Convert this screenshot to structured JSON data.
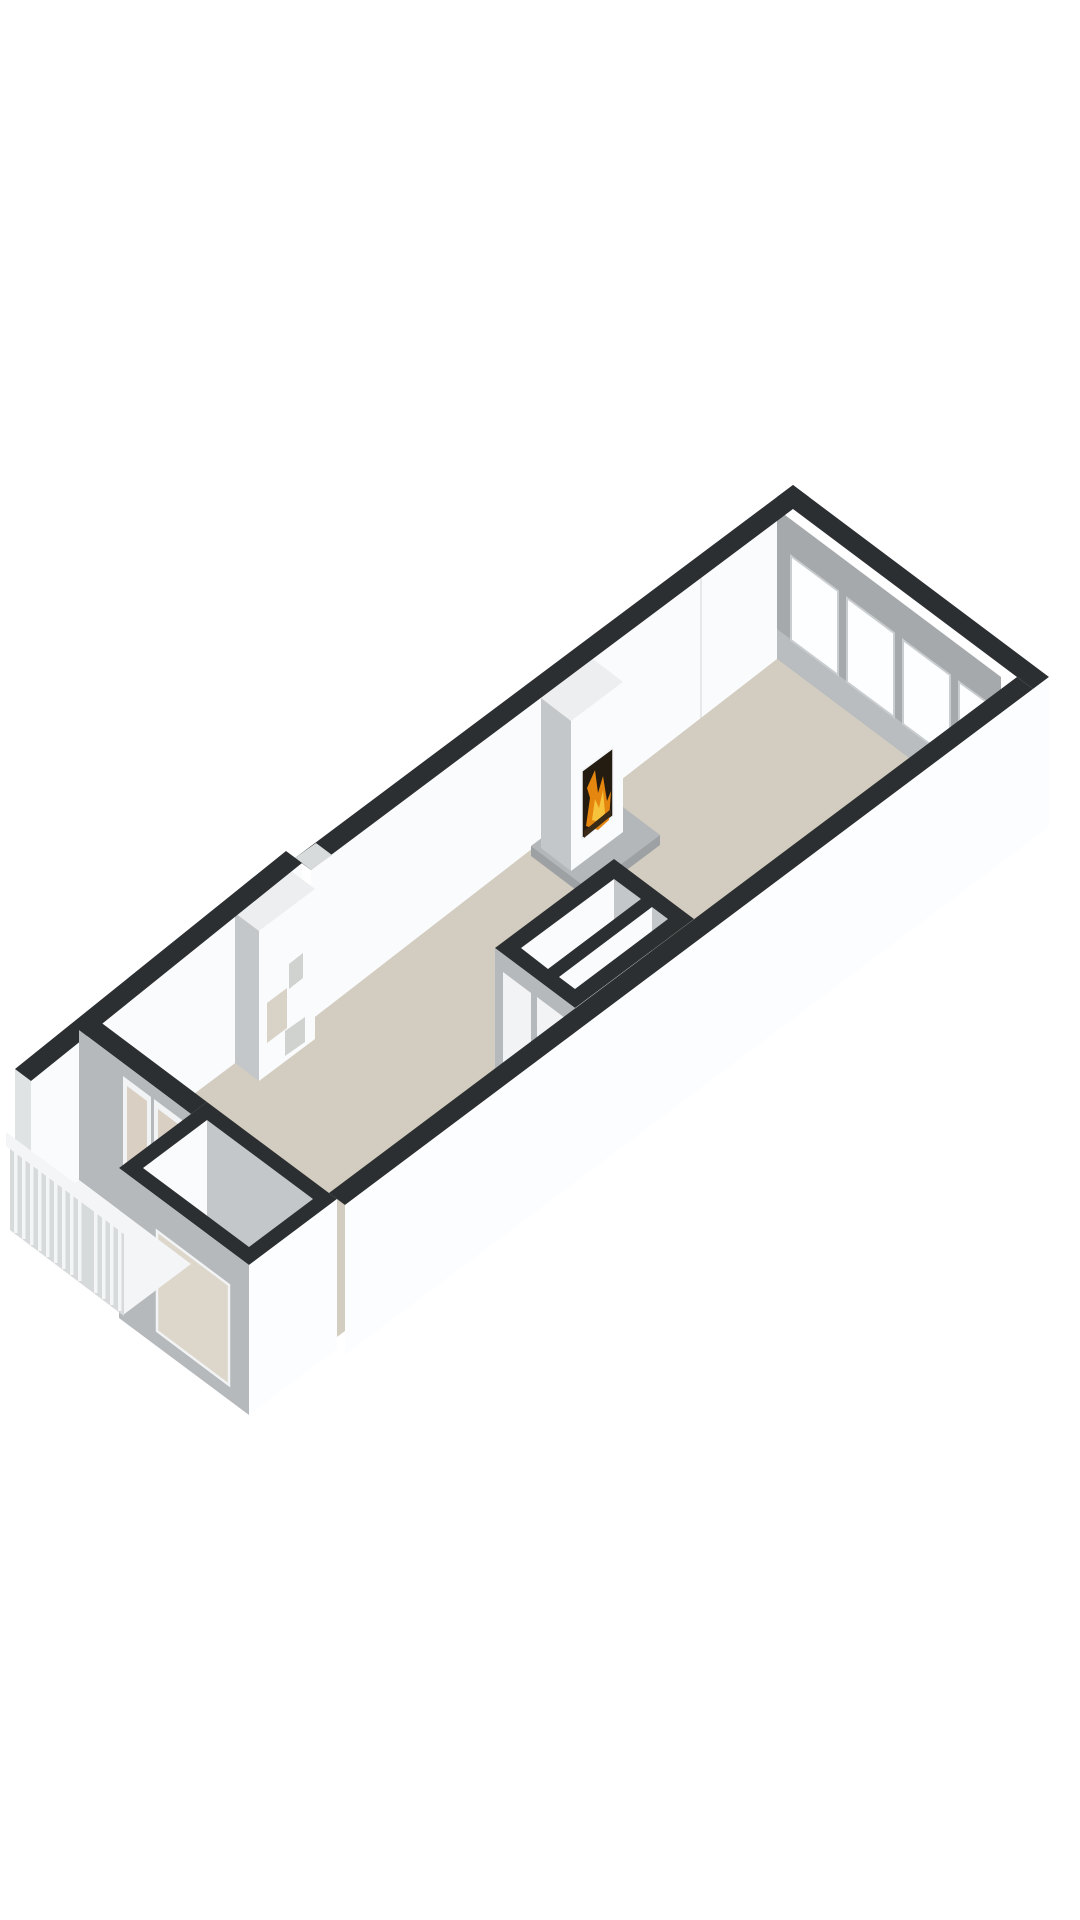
{
  "scene": {
    "title": "Isometric 3D floor plan render",
    "type": "3d-floor-plan",
    "rooms": [
      {
        "name": "living-room"
      },
      {
        "name": "hallway"
      },
      {
        "name": "bathroom"
      },
      {
        "name": "storage-room"
      },
      {
        "name": "entrance-bay"
      },
      {
        "name": "balcony"
      }
    ],
    "features": [
      {
        "name": "fireplace",
        "state": "lit"
      },
      {
        "name": "window-band",
        "panes": 4
      },
      {
        "name": "french-doors",
        "leaves": 2
      },
      {
        "name": "balcony-railing",
        "balusters": 14
      },
      {
        "name": "interior-doors",
        "count": 2
      },
      {
        "name": "bay-window",
        "panes": 1
      },
      {
        "name": "wall-niches",
        "count": 3
      }
    ]
  },
  "colors": {
    "background": "#ffffff",
    "wall_top": "#2c2f31",
    "face_white": "#fafbfd",
    "face_gray": "#b6b9bb",
    "face_gray_light": "#c4c7c9",
    "outer_white": "#fcfdfe",
    "floor": "#d3ccc0",
    "floor_room": "#eef0f1",
    "window_glass": "#fdfeff",
    "window_frame": "#c9cdcf",
    "window_lintel": "#a5a9ab",
    "window_sill": "#b9bdbf",
    "top_face": "#eceeef",
    "hearth": "#b3b7b9",
    "hearth_edge": "#9da1a3",
    "fire_dark": "#241b11",
    "fire_orange": "#e5860f",
    "fire_yellow": "#f6c33c",
    "log_brown": "#3a2a18",
    "door_frame": "#f2f3f5",
    "door_glass": "#d9d0c3",
    "handle": "#4a4c4d",
    "railing_white": "#f3f5f6",
    "railing_shadow": "#d7dadb",
    "niche": "#cfd2cf",
    "niche_beige": "#d9d2c6",
    "end_cap": "#e0e3e4",
    "slot": "#d8dbdc",
    "seam": "#e6e9ea",
    "bay_glass": "#ddd6ca"
  }
}
